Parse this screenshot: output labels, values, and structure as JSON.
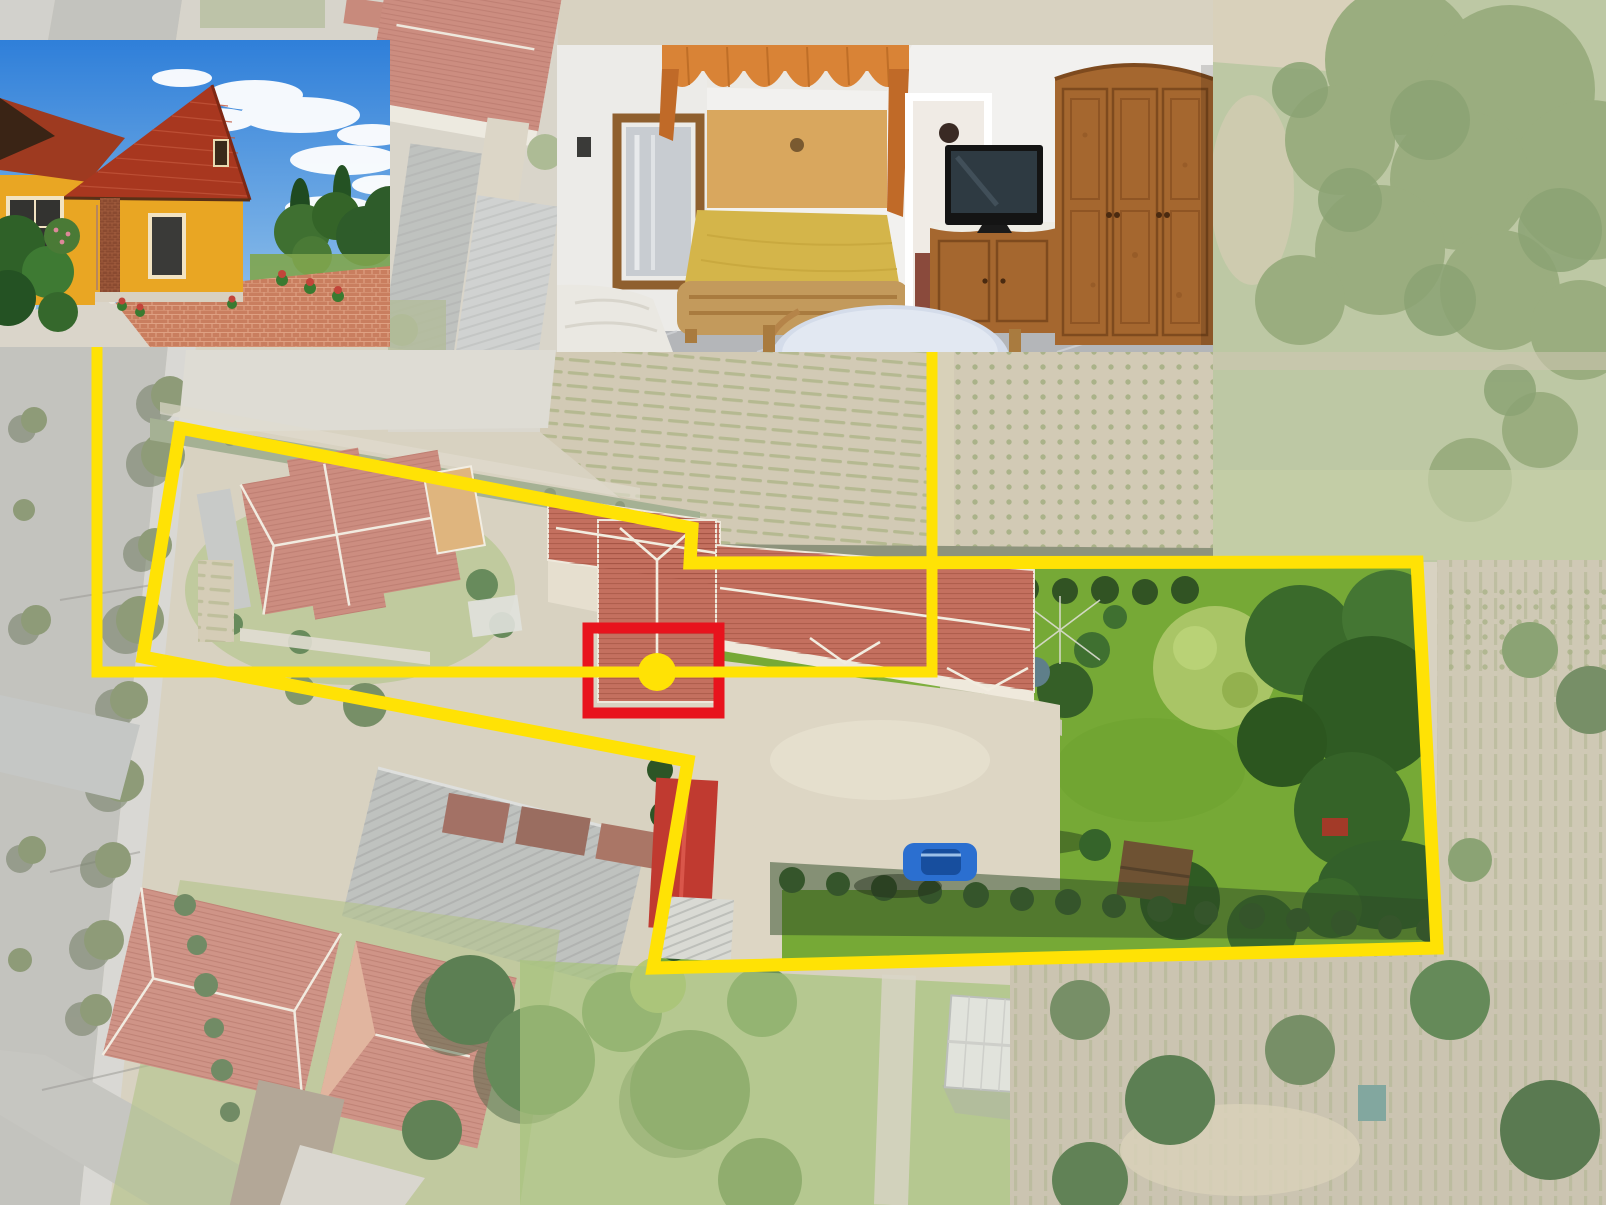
{
  "scene": {
    "kind": "real-estate-aerial-composite",
    "view": "drone-top-down-village-parcel",
    "overlay_shapes": [
      "property-boundary-polygon",
      "building-highlight-rectangle",
      "location-dot",
      "two-callout-lines"
    ],
    "inset_count": 2
  },
  "annotations": {
    "property_boundary": {
      "shape": "polygon",
      "color": "#FFE205",
      "stroke_px": 13
    },
    "building_highlight": {
      "shape": "rectangle",
      "color": "#E8131D",
      "stroke_px": 11
    },
    "location_marker": {
      "shape": "filled-dot",
      "color": "#FFE205",
      "radius_px": 19
    },
    "callout_lines": {
      "count": 2,
      "color": "#FFE205",
      "stroke_px": 11
    }
  },
  "insets": {
    "exterior": {
      "id": "house-exterior-photo",
      "subject": "yellow-cottage-red-tile-roof"
    },
    "interior": {
      "id": "bedroom-interior-photo",
      "subject": "bedroom-wood-furniture"
    }
  },
  "colors": {
    "boundary_yellow": "#FFE205",
    "highlight_red": "#E8131D",
    "base": "#CEC6B0",
    "haze": "#FFFFFF",
    "street": "#B3B2AC",
    "paving": "#D5D2C8",
    "courtyard": "#DDD6C4",
    "field": "#C6BCA0",
    "field_row": "#97A066",
    "meadow": "#ABB98B",
    "scrub": "#7E965B",
    "lawn": "#76A936",
    "tree_dark": "#2F5B23",
    "tree_mid": "#3A6A2B",
    "tree_light": "#A9C566",
    "hedge": "#315323",
    "roof_salmon": "#C4705F",
    "roof_neighbor": "#BE6D5D",
    "roof_bottom": "#C27666",
    "gray_roof": "#AEB1AE",
    "barn_red": "#C03A30",
    "car_blue": "#2B6FD0",
    "sky_top": "#2F7FD9",
    "sky_bottom": "#9CC8EC",
    "house_yellow": "#E9A623",
    "house_shade": "#D18F1E",
    "cottage_roof": "#A8371F",
    "wood": "#A5672F",
    "wood_dark": "#7E4A1E",
    "bedspread": "#D4B54A",
    "curtain": "#D98336",
    "wall_white": "#F2F1EF",
    "floor_marble": "#B4B6B9",
    "mirror_glass": "#C8CCD1"
  }
}
